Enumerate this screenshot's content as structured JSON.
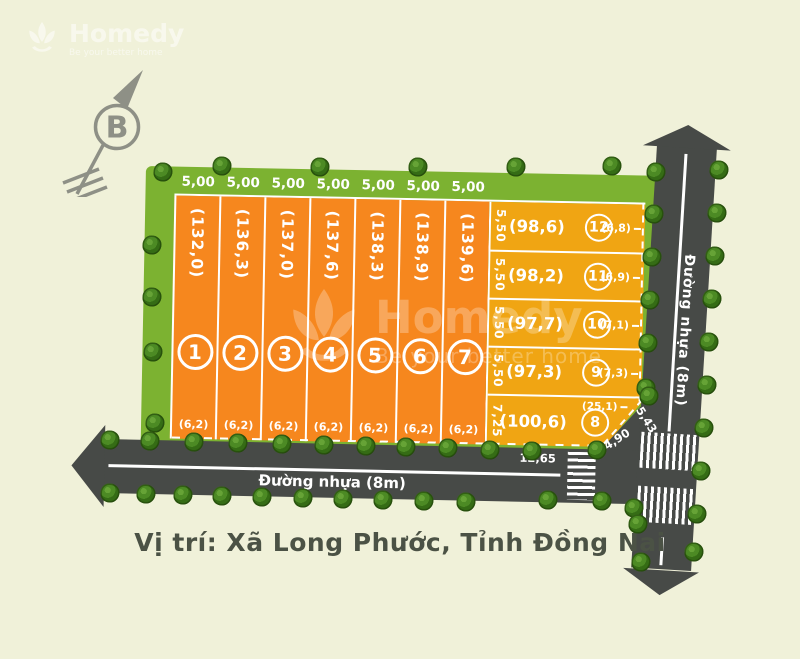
{
  "caption": "Vị trí: Xã Long Phước, Tỉnh Đồng Nai",
  "compass": {
    "label": "B"
  },
  "watermark": {
    "brand": "Homedy",
    "tagline": "Be your better home"
  },
  "roads": {
    "bottom_label": "Đường nhựa (8m)",
    "right_label": "Đường nhựa (8m)"
  },
  "junction": {
    "width_label": "12,65",
    "chamfer_label": "4,90",
    "edge_label": "5,43"
  },
  "plots_vertical": [
    {
      "id": "1",
      "area": "(132,0)",
      "width_top": "5,00",
      "frontage_bottom": "(6,2)"
    },
    {
      "id": "2",
      "area": "(136,3)",
      "width_top": "5,00",
      "frontage_bottom": "(6,2)"
    },
    {
      "id": "3",
      "area": "(137,0)",
      "width_top": "5,00",
      "frontage_bottom": "(6,2)"
    },
    {
      "id": "4",
      "area": "(137,6)",
      "width_top": "5,00",
      "frontage_bottom": "(6,2)"
    },
    {
      "id": "5",
      "area": "(138,3)",
      "width_top": "5,00",
      "frontage_bottom": "(6,2)"
    },
    {
      "id": "6",
      "area": "(138,9)",
      "width_top": "5,00",
      "frontage_bottom": "(6,2)"
    },
    {
      "id": "7",
      "area": "(139,6)",
      "width_top": "5,00",
      "frontage_bottom": "(6,2)"
    }
  ],
  "plots_horizontal": [
    {
      "id": "12",
      "area": "(98,6)",
      "depth_left": "5,50",
      "frontage_right": "(6,8)"
    },
    {
      "id": "11",
      "area": "(98,2)",
      "depth_left": "5,50",
      "frontage_right": "(6,9)"
    },
    {
      "id": "10",
      "area": "(97,7)",
      "depth_left": "5,50",
      "frontage_right": "(7,1)"
    },
    {
      "id": "9",
      "area": "(97,3)",
      "depth_left": "5,50",
      "frontage_right": "(7,3)"
    },
    {
      "id": "8",
      "area": "(100,6)",
      "depth_left": "7,25",
      "frontage_right": "(25,1)"
    }
  ],
  "colors": {
    "cream": "#f0f1d9",
    "green": "#7cb231",
    "orange": "#f6871e",
    "amber": "#f0a513",
    "road": "#474a47",
    "title": "#4b5245",
    "compass": "#8e9086"
  }
}
